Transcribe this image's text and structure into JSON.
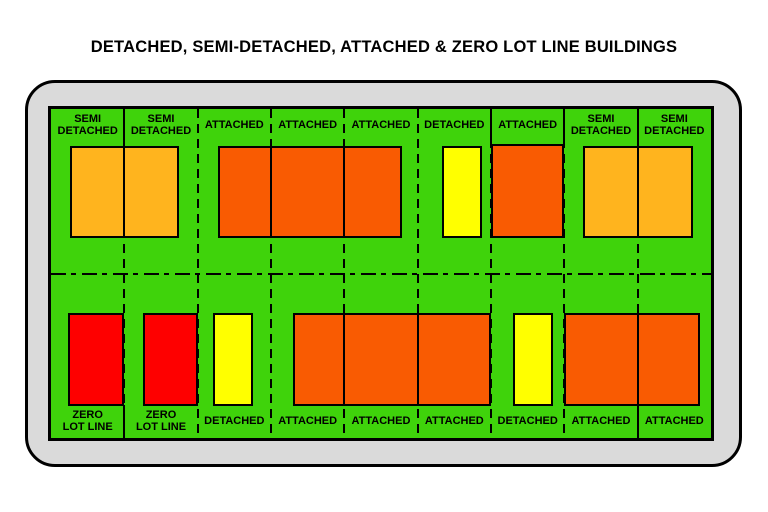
{
  "title": "DETACHED, SEMI-DETACHED, ATTACHED & ZERO LOT LINE BUILDINGS",
  "colors": {
    "ground": "#3FD30B",
    "frame": "#DADADA",
    "outline": "#000000",
    "semi_detached": "#FFB41E",
    "attached": "#F95B02",
    "detached": "#FFFF00",
    "zero_lot_line": "#FE0000"
  },
  "plan": {
    "lot_count_per_row": 9,
    "lot_width": 73.333,
    "rows": {
      "top": {
        "lots": [
          "SEMI|DETACHED",
          "SEMI|DETACHED",
          "ATTACHED",
          "ATTACHED",
          "ATTACHED",
          "DETACHED",
          "ATTACHED",
          "SEMI|DETACHED",
          "SEMI|DETACHED"
        ]
      },
      "bottom": {
        "lots": [
          "ZERO|LOT LINE",
          "ZERO|LOT LINE",
          "DETACHED",
          "ATTACHED",
          "ATTACHED",
          "ATTACHED",
          "DETACHED",
          "ATTACHED",
          "ATTACHED"
        ]
      }
    },
    "lot_line_xs": [
      73.33,
      146.67,
      220,
      293.33,
      366.67,
      440,
      513.33,
      586.67
    ],
    "solid_segments": [
      {
        "x": 73.33,
        "y": 0,
        "h": 38
      },
      {
        "x": 73.33,
        "y": 296,
        "h": 33
      },
      {
        "x": 440,
        "y": 0,
        "h": 36
      },
      {
        "x": 513.33,
        "y": 0,
        "h": 36
      },
      {
        "x": 586.67,
        "y": 0,
        "h": 38
      },
      {
        "x": 586.67,
        "y": 296,
        "h": 33
      }
    ],
    "centerline_y": 163.5,
    "buildings": [
      {
        "name": "building-semi-detached-pair-top-left",
        "type": "semi_detached",
        "x": 19,
        "y": 37,
        "w": 109,
        "h": 92,
        "walls": [
          73.33
        ]
      },
      {
        "name": "building-attached-row-top",
        "type": "attached",
        "x": 167,
        "y": 37,
        "w": 184,
        "h": 92,
        "walls": [
          220,
          293.33
        ]
      },
      {
        "name": "building-detached-top",
        "type": "detached",
        "x": 391,
        "y": 37,
        "w": 40,
        "h": 92,
        "walls": []
      },
      {
        "name": "building-attached-top-single",
        "type": "attached",
        "x": 440,
        "y": 35,
        "w": 73.33,
        "h": 94,
        "walls": []
      },
      {
        "name": "building-semi-detached-pair-top-right",
        "type": "semi_detached",
        "x": 532,
        "y": 37,
        "w": 110,
        "h": 92,
        "walls": [
          586.67
        ]
      },
      {
        "name": "building-zero-lot-line-1",
        "type": "zero_lot_line",
        "x": 17,
        "y": 204,
        "w": 56.33,
        "h": 93,
        "walls": []
      },
      {
        "name": "building-zero-lot-line-2",
        "type": "zero_lot_line",
        "x": 92,
        "y": 204,
        "w": 54.67,
        "h": 93,
        "walls": []
      },
      {
        "name": "building-detached-bottom-left",
        "type": "detached",
        "x": 162,
        "y": 204,
        "w": 40,
        "h": 93,
        "walls": []
      },
      {
        "name": "building-attached-row-bottom",
        "type": "attached",
        "x": 242,
        "y": 204,
        "w": 198.33,
        "h": 93,
        "walls": [
          293.33,
          366.67
        ]
      },
      {
        "name": "building-detached-bottom-right",
        "type": "detached",
        "x": 462,
        "y": 204,
        "w": 40,
        "h": 93,
        "walls": []
      },
      {
        "name": "building-attached-pair-bottom",
        "type": "attached",
        "x": 513.33,
        "y": 204,
        "w": 136,
        "h": 93,
        "walls": [
          586.67
        ]
      }
    ]
  }
}
